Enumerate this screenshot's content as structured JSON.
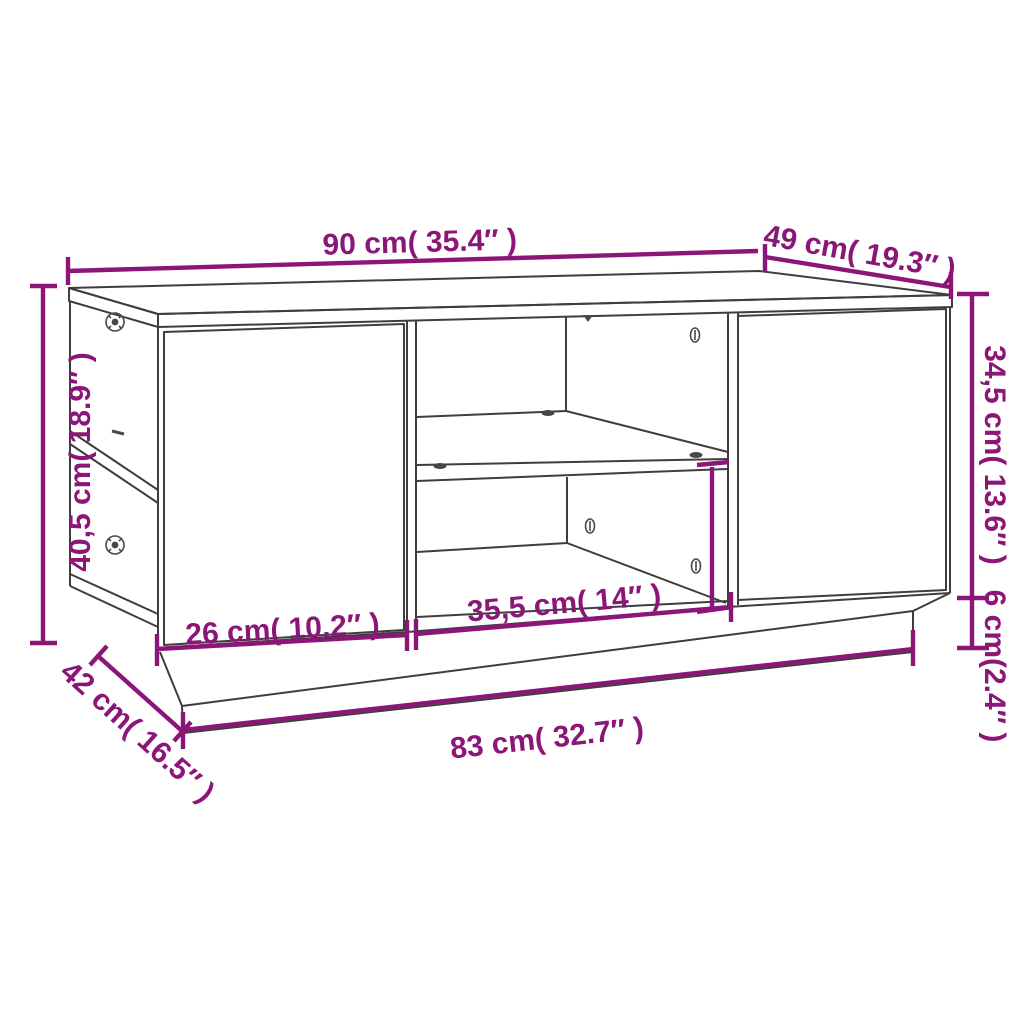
{
  "colors": {
    "dimension_accent": "#8b1678",
    "outline": "#3e3e3e",
    "background": "#ffffff"
  },
  "labels": {
    "top_width": "90 cm( 35.4″ )",
    "top_depth": "49 cm( 19.3″ )",
    "left_height": "40,5 cm( 18.9″ )",
    "right_body_height": "34,5 cm( 13.6″ )",
    "right_base_height": "6 cm(2.4″ )",
    "left_door_width": "26 cm( 10.2″ )",
    "middle_opening_width": "35,5 cm( 14″ )",
    "base_width": "83 cm( 32.7″ )",
    "bottom_depth": "42 cm( 16.5″ )"
  }
}
